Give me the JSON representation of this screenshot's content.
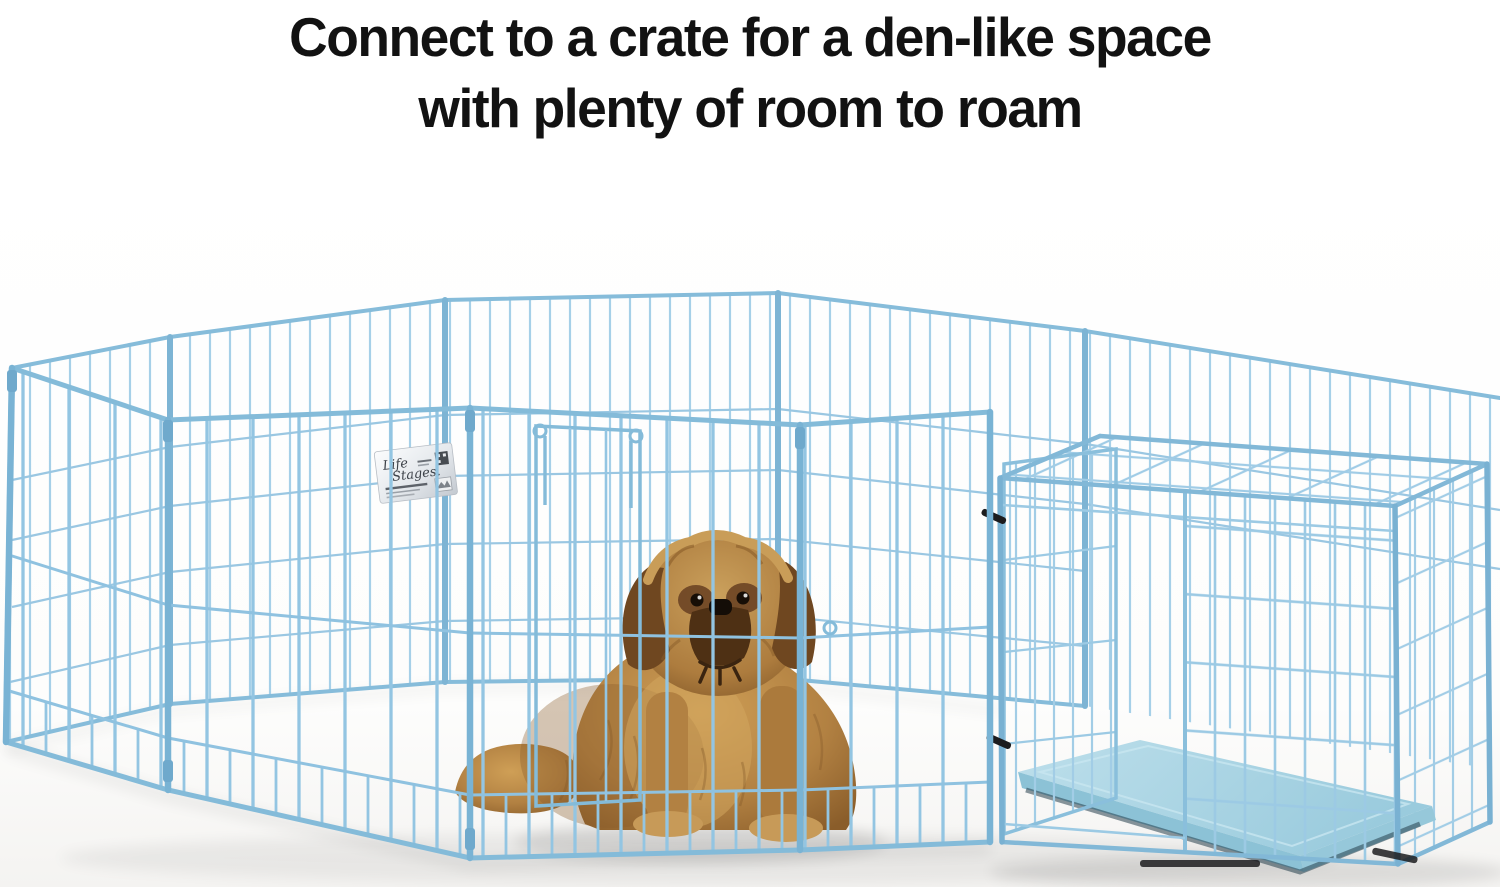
{
  "headline": {
    "line1": "Connect to a crate for a den-like space",
    "line2": "with plenty of room to roam"
  },
  "product_label": {
    "brand_line1": "Life",
    "brand_line2": "Stages."
  },
  "colors": {
    "headline_text": "#121212",
    "background": "#ffffff",
    "pen_wire_blue": "#9cc9e5",
    "pen_frame_blue": "#84bbd9",
    "crate_wire_blue": "#9ccae4",
    "pan_blue": "#a9d6e4",
    "dog_coat_brown": "#b28142",
    "dog_shadow_brown": "#7e5526",
    "dog_face_dark": "#4e3014",
    "label_silver": "#dfe3e7",
    "clip_black": "#1c1c1e"
  }
}
